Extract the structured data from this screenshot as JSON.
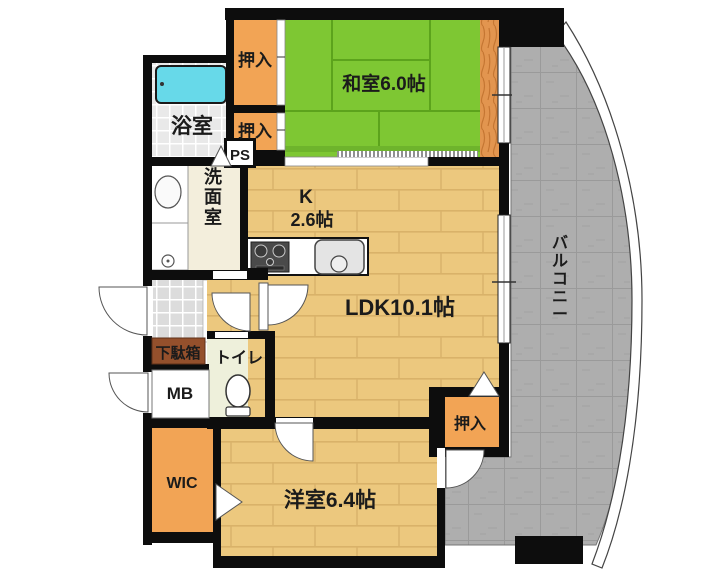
{
  "plan": {
    "type": "japanese-apartment-floor-plan",
    "rooms": {
      "washitsu": {
        "label": "和室6.0帖"
      },
      "ldk": {
        "label": "LDK10.1帖"
      },
      "kitchen": {
        "label": "K",
        "size": "2.6帖"
      },
      "youshitsu": {
        "label": "洋室6.4帖"
      },
      "yokushitsu": {
        "label": "浴室"
      },
      "senmen": {
        "label": "洗面室"
      },
      "toilet": {
        "label": "トイレ"
      },
      "balcony": {
        "label": "バルコニー"
      },
      "wic": {
        "label": "WIC"
      },
      "mb": {
        "label": "MB"
      },
      "ps": {
        "label": "PS"
      },
      "getabako": {
        "label": "下駄箱"
      },
      "oshiire_top": {
        "label": "押入"
      },
      "oshiire_mid": {
        "label": "押入"
      },
      "oshiire_ldk": {
        "label": "押入"
      }
    },
    "colors": {
      "wall": "#0d0d0d",
      "tatami": "#7EC733",
      "tatamiLine": "#5CA31C",
      "tatamiEdge": "#6EB42C",
      "wood": "#ECC87E",
      "closet": "#F2A455",
      "grain": "#E2954F",
      "balcony": "#AEAEAE",
      "bathFloor": "#E9E9E9",
      "tileFloor": "#DCDCDC",
      "cream": "#F3EEDC",
      "toiletFloor": "#EEF0DB",
      "tub": "#67D9E9",
      "getabakoBox": "#94502C"
    }
  }
}
